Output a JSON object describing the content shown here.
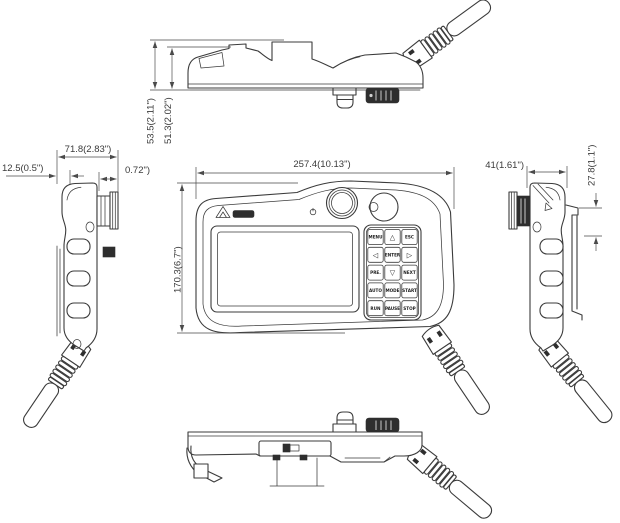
{
  "page": {
    "background": "#ffffff",
    "line_color": "#3b3b3b",
    "dark_fill": "#2e2e2e"
  },
  "dimensions": {
    "top_view_total_height": "53.5(2.11\")",
    "top_view_body_height": "51.3(2.02\")",
    "left_view_depth": "71.8(2.83\")",
    "left_view_offset": "12.5(0.5\")",
    "left_view_knob_depth": "0.72\")",
    "front_view_width": "257.4(10.13\")",
    "front_view_height": "170.3(6.7\")",
    "right_view_depth": "41(1.61\")",
    "right_view_top_offset": "27.8(1.1\")"
  },
  "keypad": {
    "rows": [
      [
        "MENU",
        "△",
        "ESC"
      ],
      [
        "◁",
        "ENTER",
        "▷"
      ],
      [
        "PRE.",
        "▽",
        "NEXT"
      ],
      [
        "AUTO",
        "MODE",
        "START"
      ],
      [
        "RUN",
        "PAUSE",
        "STOP"
      ]
    ]
  }
}
